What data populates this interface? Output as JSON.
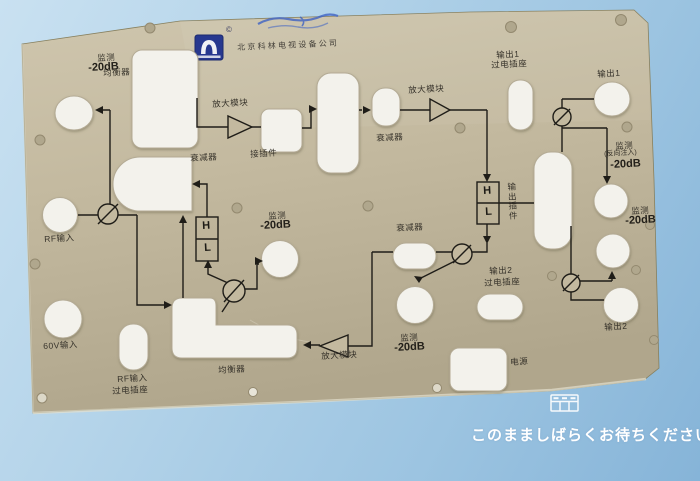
{
  "colors": {
    "background_blue": "#9cc4e1",
    "panel_beige": "#c3b99f",
    "hole_white": "#f3f2ec",
    "line_black": "#1f1d18",
    "logo_blue": "#27388f",
    "wait_text_white": "#ffffff"
  },
  "panel": {
    "logo": {
      "mark": "©",
      "company": "北京科林电视设备公司"
    },
    "labels": {
      "monitor": "监测",
      "minus20db": "-20dB",
      "equalizer": "均衡器",
      "attenuator": "衰减器",
      "amplifier_module": "放大模块",
      "connector": "接插件",
      "rf_input": "RF输入",
      "v60_input": "60V输入",
      "feedthrough_socket": "过电插座",
      "output1": "输出1",
      "output2": "输出2",
      "output_plugin": "输出插件",
      "reverse_injection": "(反向注入)",
      "power": "电源",
      "high": "H",
      "low": "L"
    }
  },
  "overlay": {
    "wait_message": "このまましばらくお待ちください。",
    "icon": "table-grid-icon"
  }
}
